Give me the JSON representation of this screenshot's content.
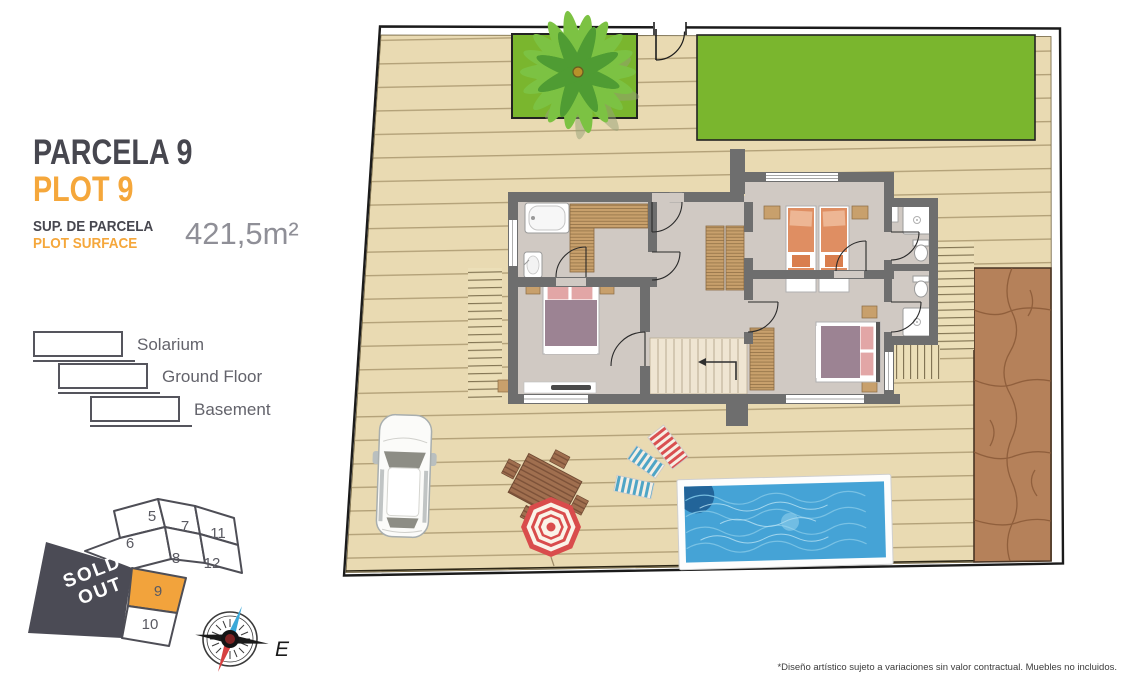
{
  "panel": {
    "title_primary": "PARCELA 9",
    "title_secondary": "PLOT 9",
    "surface_label_primary": "SUP. DE PARCELA",
    "surface_label_secondary": "PLOT SURFACE",
    "surface_value": "421,5m²"
  },
  "legend": {
    "items": [
      {
        "label": "Solarium"
      },
      {
        "label": "Ground Floor"
      },
      {
        "label": "Basement"
      }
    ]
  },
  "minimap": {
    "plots": [
      {
        "label": "5"
      },
      {
        "label": "7"
      },
      {
        "label": "11"
      },
      {
        "label": "6"
      },
      {
        "label": "8"
      },
      {
        "label": "12"
      },
      {
        "label": "9"
      },
      {
        "label": "10"
      }
    ],
    "highlighted_plot": "9",
    "sold_out_line1": "SOLD",
    "sold_out_line2": "OUT"
  },
  "compass": {
    "east_label": "E"
  },
  "footer": {
    "disclaimer": "*Diseño artístico sujeto a variaciones sin valor contractual. Muebles no incluidos."
  },
  "colors": {
    "accent_orange": "#F5A73B",
    "heading_dark": "#47474F",
    "sold_out_bg": "#4B4B55",
    "plot_highlight": "#F2A33C",
    "garden_green": "#7AB62E",
    "deck_wood": "#E9DAB2",
    "pool_water": "#45A3D6",
    "terrain_brown": "#B5815A",
    "wall_gray": "#6E6E6E",
    "floor_gray": "#D0C9C3"
  }
}
